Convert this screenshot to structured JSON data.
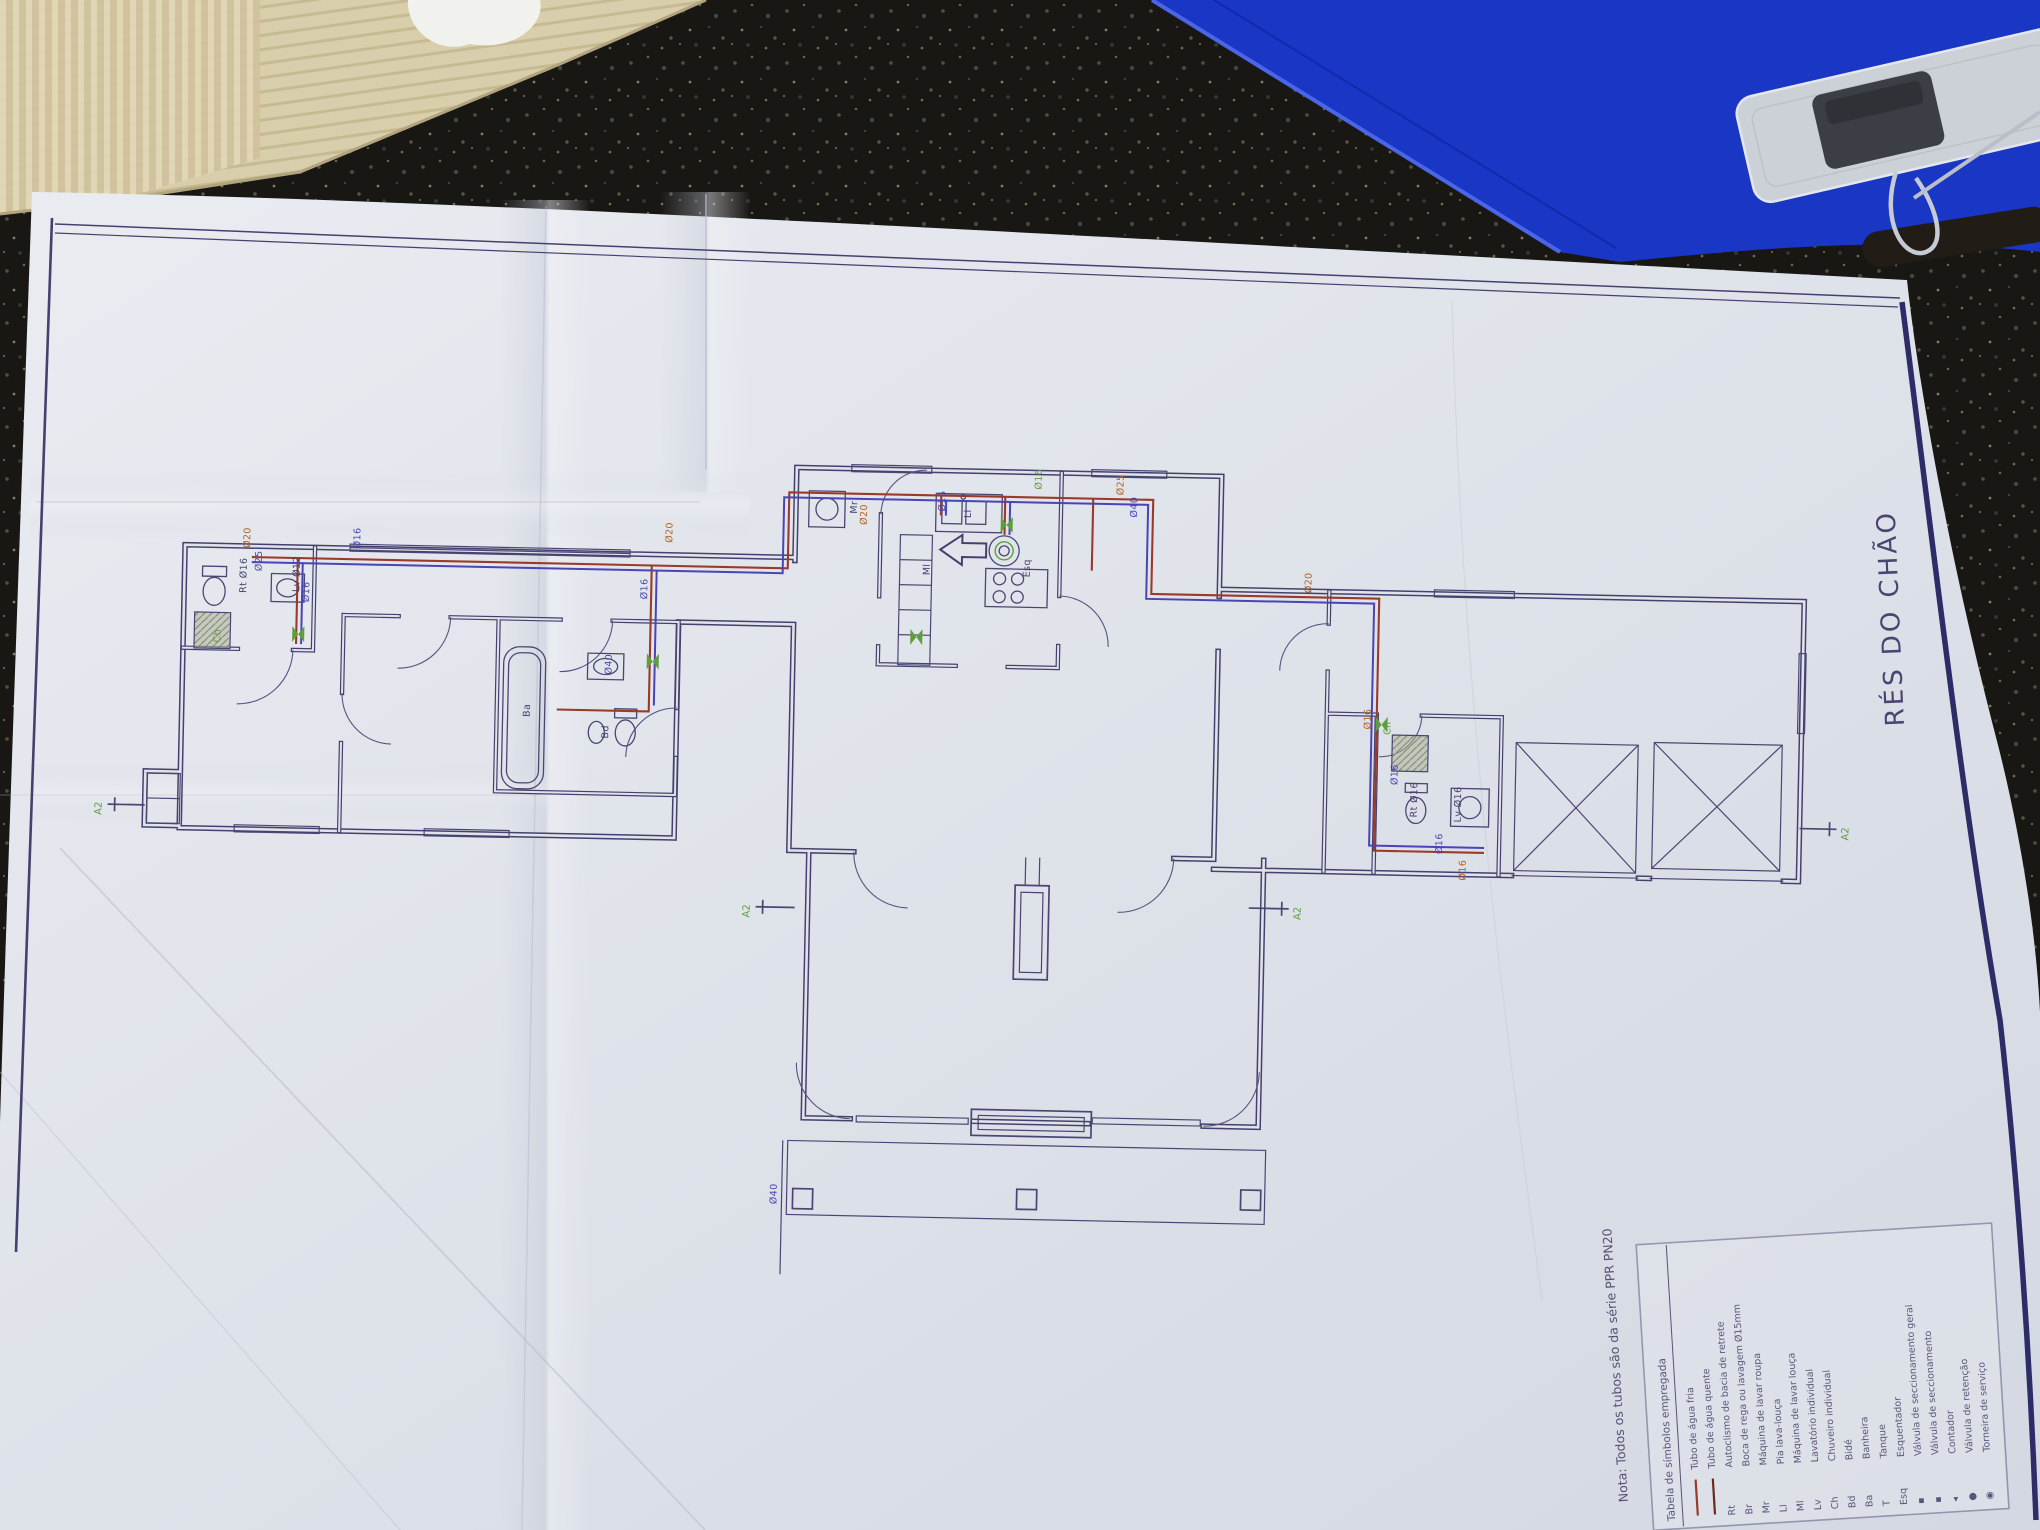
{
  "drawing": {
    "title": "RÉS DO CHÃO",
    "note": "Nota:  Todos os tubos são da série PPR PN20",
    "section_marker": "A2",
    "legend": {
      "title": "Tabela de símbolos empregada",
      "entries": [
        {
          "symbol_type": "line",
          "color": "#9a3a29",
          "label": "Tubo de água fria"
        },
        {
          "symbol_type": "line",
          "color": "#6b2a1e",
          "label": "Tubo de água quente"
        },
        {
          "symbol": "Rt",
          "label": "Autoclismo de bacia de retrete"
        },
        {
          "symbol": "Br",
          "label": "Boca de rega ou lavagem Ø15mm"
        },
        {
          "symbol": "Mr",
          "label": "Máquina de lavar roupa"
        },
        {
          "symbol": "Ll",
          "label": "Pia lava-louça"
        },
        {
          "symbol": "Ml",
          "label": "Máquina de lavar louça"
        },
        {
          "symbol": "Lv",
          "label": "Lavatório individual"
        },
        {
          "symbol": "Ch",
          "label": "Chuveiro individual"
        },
        {
          "symbol": "Bd",
          "label": "Bidé"
        },
        {
          "symbol": "Ba",
          "label": "Banheira"
        },
        {
          "symbol": "T",
          "label": "Tanque"
        },
        {
          "symbol": "Esq",
          "label": "Esquentador"
        },
        {
          "symbol": "▪",
          "label": "Válvula de seccionamento geral"
        },
        {
          "symbol": "▪",
          "label": "Válvula de seccionamento"
        },
        {
          "symbol": "◂",
          "label": "Contador"
        },
        {
          "symbol": "●",
          "label": "Válvula de retenção"
        },
        {
          "symbol": "◉",
          "label": "Torneira de serviço"
        }
      ]
    },
    "pipe_labels": {
      "d12": "Ø12",
      "d16": "Ø16",
      "d20": "Ø20",
      "d25": "Ø25",
      "d40": "Ø40"
    },
    "fixture_labels": {
      "rt": "Rt",
      "lv": "Lv",
      "ch": "Ch",
      "ba": "Ba",
      "bd": "Bd",
      "ml": "Ml",
      "mr": "Mr",
      "ll": "Ll",
      "esq": "Esq",
      "rt16": "Rt Ø16",
      "lv16": "Lv Ø16",
      "lv12": "Lv Ø12"
    },
    "colors": {
      "print_navy": "#45416e",
      "pipe_cold": "#9a3a29",
      "pipe_hot": "#4a44b4",
      "label_orange": "#b4611e",
      "label_green": "#5e9e3e",
      "paper": "#dfe3ea",
      "folder_blue": "#1a36c4",
      "counter_dark": "#191714",
      "cardboard": "#d9ceab"
    }
  }
}
